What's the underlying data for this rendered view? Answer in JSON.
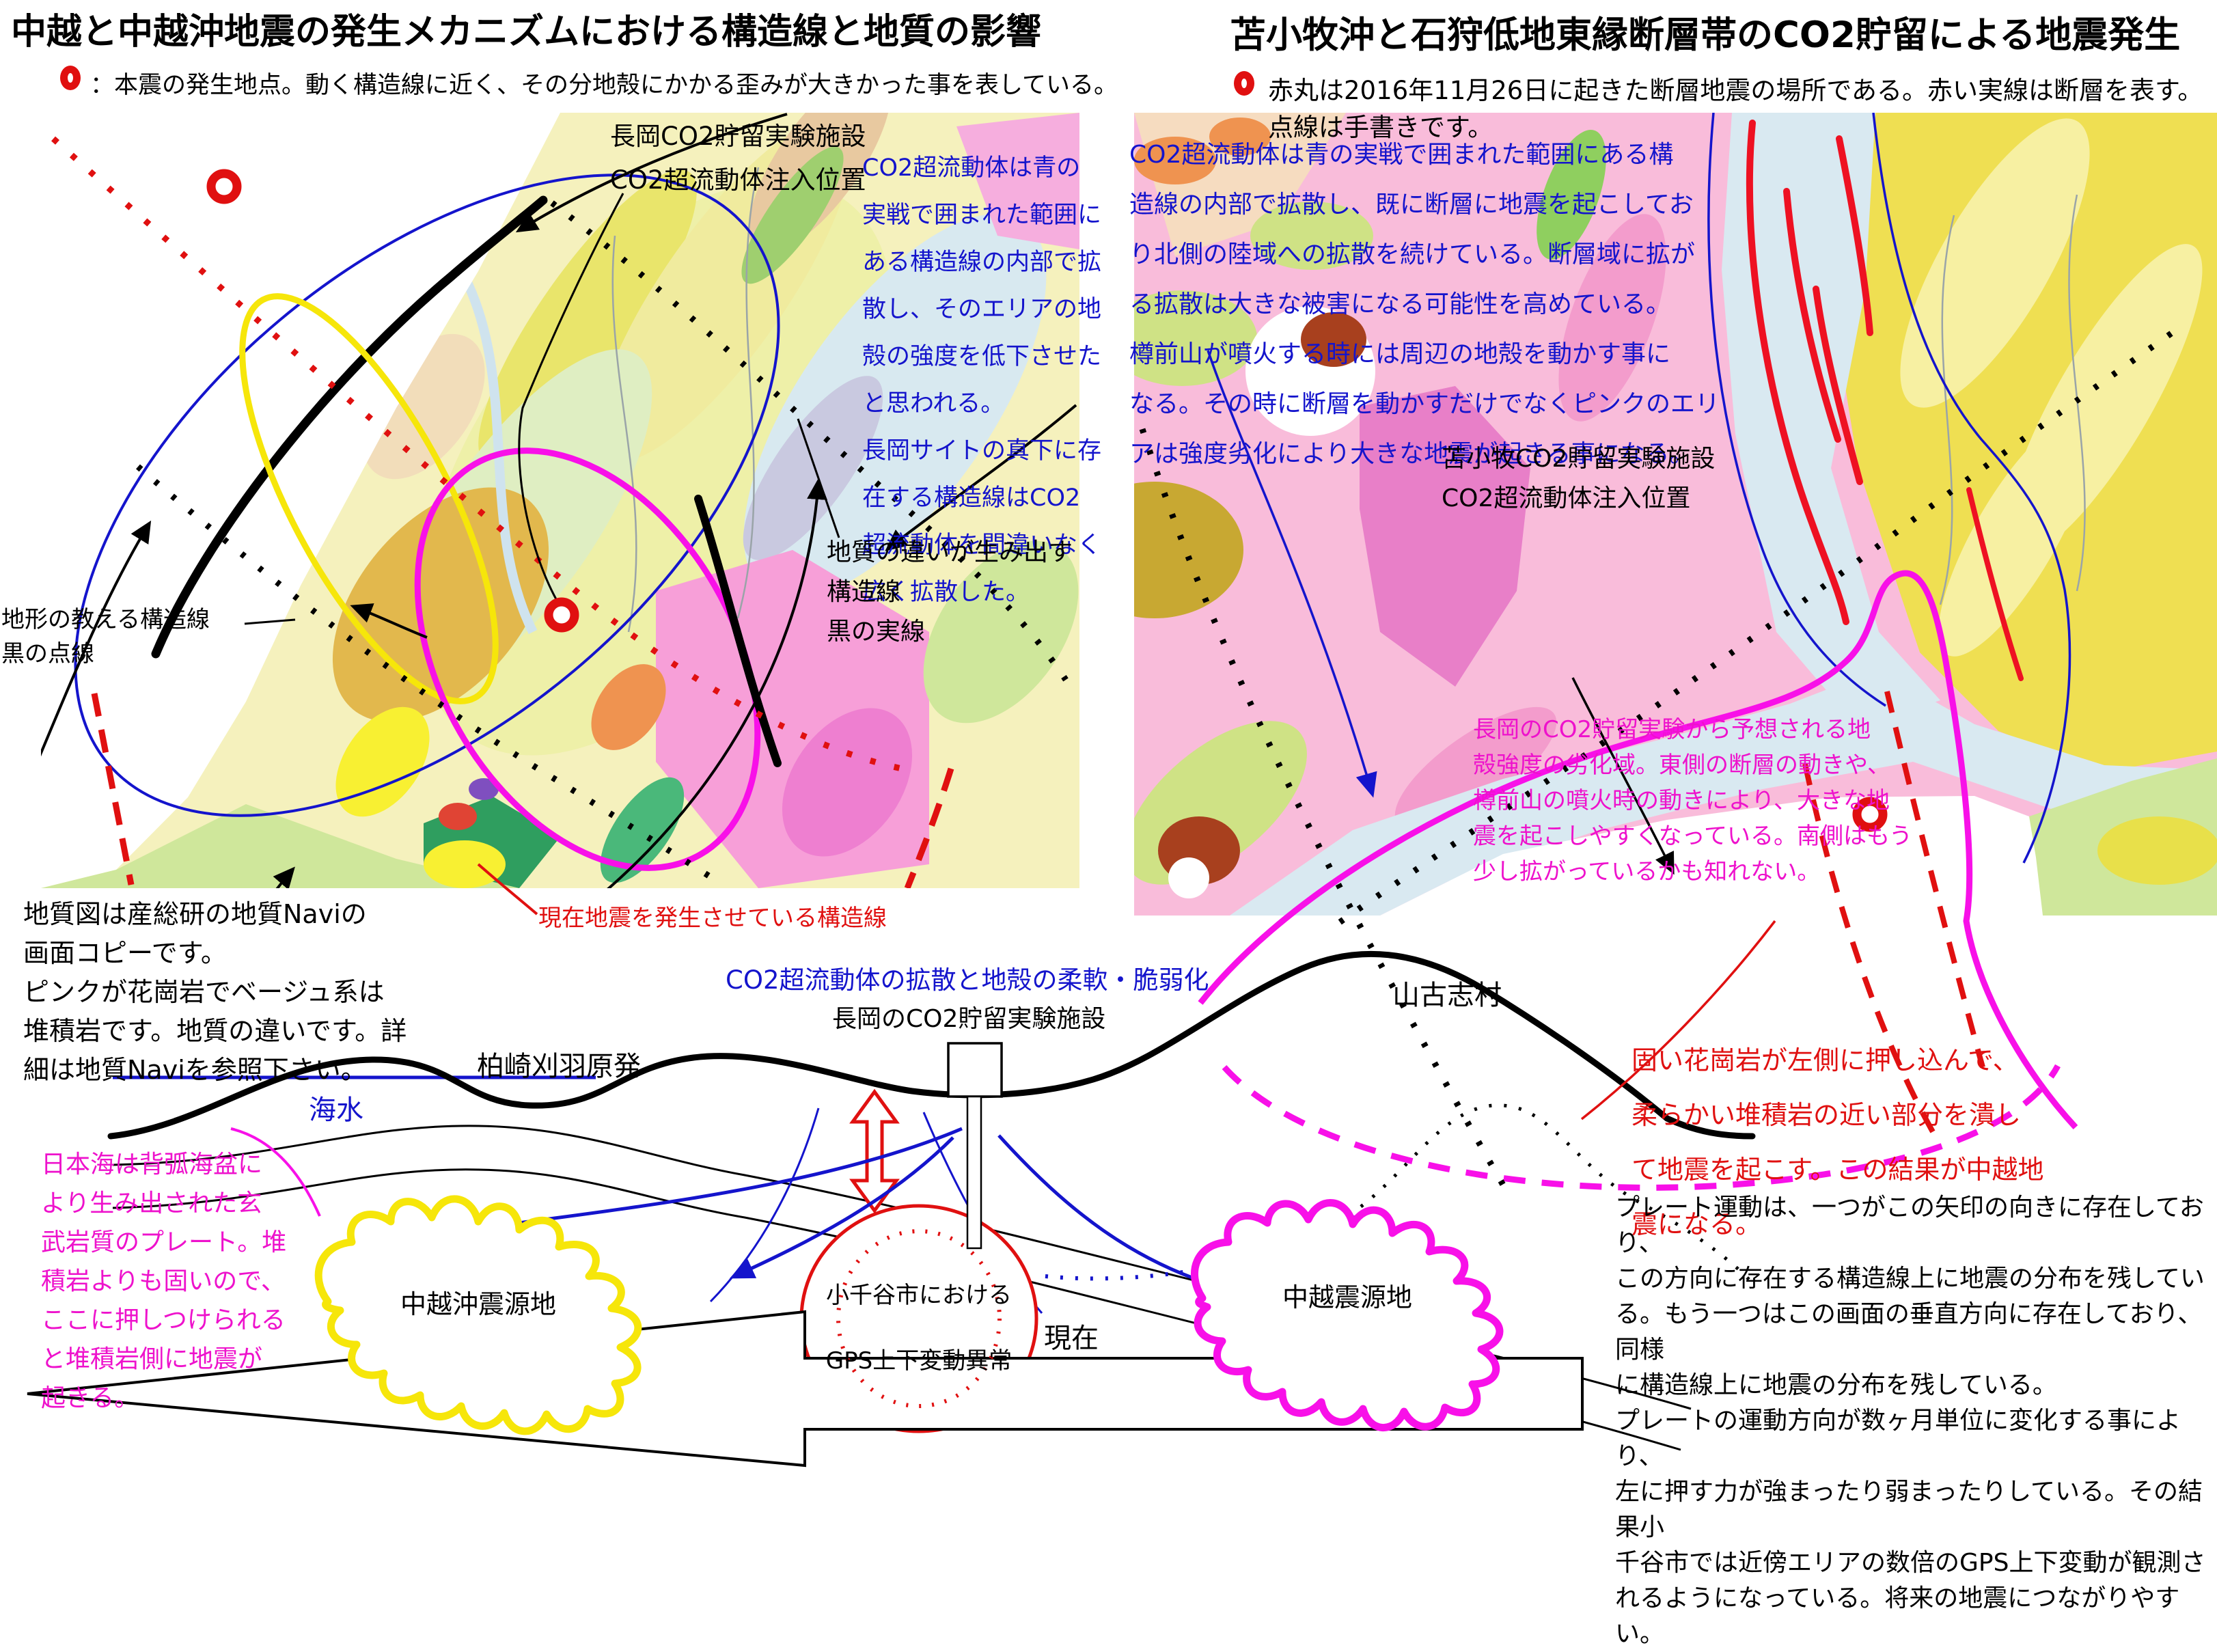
{
  "palette": {
    "annotation_blue": "#1414cc",
    "annotation_red": "#e01010",
    "annotation_magenta": "#ee12cc",
    "fault_red": "#ee1122",
    "structure_yellow": "#f6e60a",
    "structure_magenta": "#f810e8",
    "granite_pink": "#f9bcda",
    "sediment_beige": "#f5f1bd"
  },
  "left": {
    "title": "中越と中越沖地震の発生メカニズムにおける構造線と地質の影響",
    "legend": "：本震の発生地点。動く構造線に近く、その分地殻にかかる歪みが大きかった事を表している。",
    "labels": {
      "facility": "長岡CO2貯留実験施設\nCO2超流動体注入位置",
      "geology_fault": "地質の違いが生み出す\n構造線\n黒の実線",
      "topo_fault": "地形の教える構造線\n黒の点線",
      "current_fault": "現在地震を発生させている構造線"
    },
    "notes": {
      "diffusion": "CO2超流動体は青の\n実戦で囲まれた範囲に\nある構造線の内部で拡\n散し、そのエリアの地\n殻の強度を低下させた\nと思われる。\n長岡サイトの真下に存\n在する構造線はCO2\n超流動体を間違いなく\n広く拡散した。",
      "geonavi": "地質図は産総研の地質Naviの\n画面コピーです。\nピンクが花崗岩でベージュ系は\n堆積岩です。地質の違いです。詳\n細は地質Naviを参照下さい。"
    }
  },
  "right": {
    "title": "苫小牧沖と石狩低地東縁断層帯のCO2貯留による地震発生",
    "legend": "赤丸は2016年11月26日に起きた断層地震の場所である。赤い実線は断層を表す。点線は手書きです。",
    "labels": {
      "facility": "苫小牧CO2貯留実験施設\nCO2超流動体注入位置"
    },
    "notes": {
      "diffusion": "CO2超流動体は青の実戦で囲まれた範囲にある構\n造線の内部で拡散し、既に断層に地震を起こしてお\nり北側の陸域への拡散を続けている。断層域に拡が\nる拡散は大きな被害になる可能性を高めている。\n樽前山が噴火する時には周辺の地殻を動かす事に\nなる。その時に断層を動かすだけでなくピンクのエリ\nアは強度劣化により大きな地震が起きる事になる。",
      "weakened_zone": "長岡のCO2貯留実験から予想される地\n殻強度の劣化域。東側の断層の動きや、\n樽前山の噴火時の動きにより、大きな地\n震を起こしやすくなっている。南側はもう\n少し拡がっているかも知れない。"
    }
  },
  "bottom": {
    "heading": "CO2超流動体の拡散と地殻の柔軟・脆弱化",
    "labels": {
      "nagaoka_site": "長岡のCO2貯留実験施設",
      "kashiwazaki": "柏崎刈羽原発",
      "seawater": "海水",
      "yamakoshi": "山古志村",
      "genzai": "現在",
      "chuetsu_oki": "中越沖震源地",
      "chuetsu": "中越震源地",
      "gps": "小千谷市における\nGPS上下変動異常"
    },
    "notes": {
      "japan_sea": "日本海は背弧海盆に\nより生み出された玄\n武岩質のプレート。堆\n積岩よりも固いので、\nここに押しつけられる\nと堆積岩側に地震が\n起きる。",
      "granite": "固い花崗岩が左側に押し込んで、\n柔らかい堆積岩の近い部分を潰し\nて地震を起こす。この結果が中越地\n震になる。",
      "plate": "プレート運動は、一つがこの矢印の向きに存在しており、\nこの方向に存在する構造線上に地震の分布を残してい\nる。もう一つはこの画面の垂直方向に存在しており、同様\nに構造線上に地震の分布を残している。\nプレートの運動方向が数ヶ月単位に変化する事により、\n左に押す力が強まったり弱まったりしている。その結果小\n千谷市では近傍エリアの数倍のGPS上下変動が観測さ\nれるようになっている。将来の地震につながりやすい。"
    }
  }
}
